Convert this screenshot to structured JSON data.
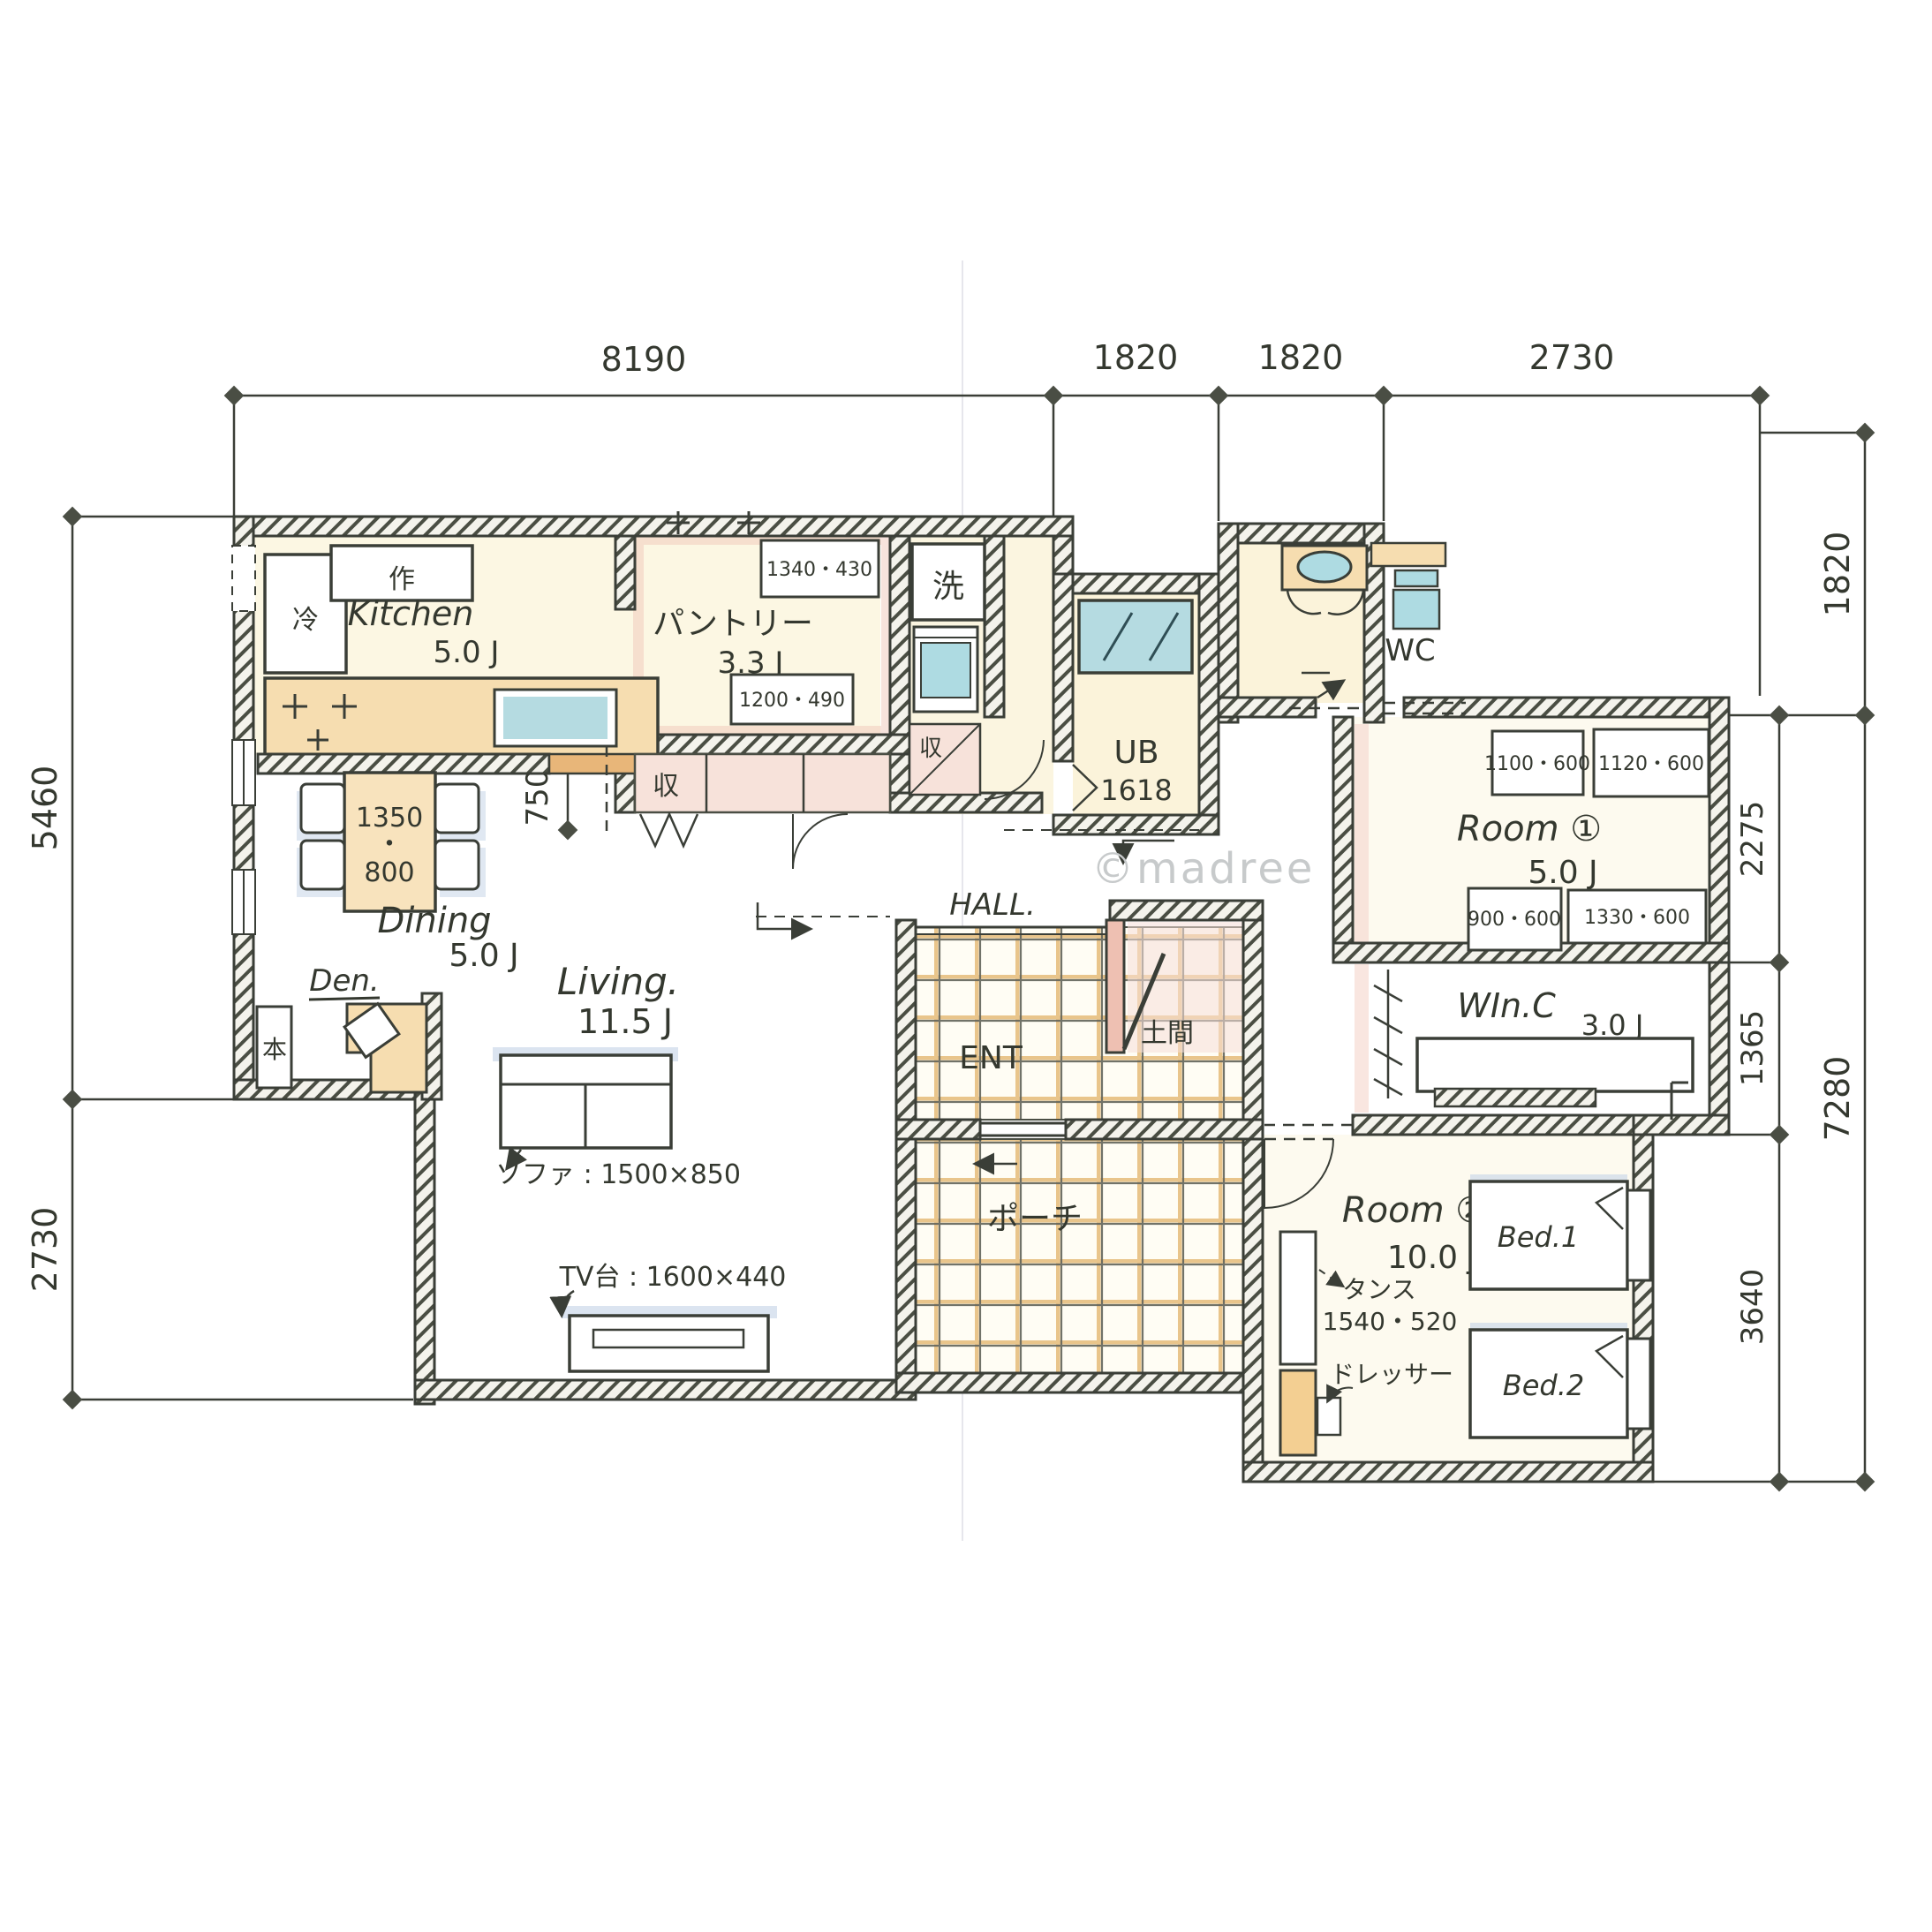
{
  "watermark": "©madree",
  "dimensions": {
    "top": [
      "8190",
      "1820",
      "1820",
      "2730"
    ],
    "left": [
      "5460",
      "2730"
    ],
    "right_outer": [
      "1820",
      "7280"
    ],
    "right_inner": [
      "2275",
      "1365",
      "3640"
    ],
    "kitchen_opening": [
      "1980",
      "750"
    ]
  },
  "rooms": {
    "kitchen": {
      "label": "Kitchen",
      "size": "5.0 J"
    },
    "pantry": {
      "label": "パントリー",
      "size": "3.3 J"
    },
    "dining": {
      "label": "Dining",
      "size": "5.0 J"
    },
    "living": {
      "label": "Living.",
      "size": "11.5 J"
    },
    "den": {
      "label": "Den."
    },
    "hall": {
      "label": "HALL."
    },
    "entrance": {
      "label": "ENT"
    },
    "doma": {
      "label": "土間"
    },
    "porch": {
      "label": "ポーチ"
    },
    "bath": {
      "label": "UB",
      "size": "1618"
    },
    "wc": {
      "label": "WC"
    },
    "room1": {
      "label": "Room ①",
      "size": "5.0 J"
    },
    "wic": {
      "label": "WIn.C",
      "size": "3.0 J"
    },
    "room2": {
      "label": "Room ②",
      "size": "10.0 J"
    }
  },
  "furniture": {
    "fridge": "冷",
    "work_counter": "作",
    "washer": "洗",
    "storage_pantry": "収",
    "storage_wash": "収",
    "bookshelf": "本",
    "dining_table": {
      "w": "1350",
      "sep": "・",
      "d": "800"
    },
    "sofa": "ソファ : 1500×850",
    "tv": "TV台 : 1600×440",
    "bed1": "Bed.1",
    "bed2": "Bed.2",
    "tansu_label": "タンス",
    "tansu_size": "1540・520",
    "dresser": "ドレッサー"
  },
  "closets": {
    "pantry_box1": "1340・430",
    "pantry_box2": "1200・490",
    "room1_box1": "1100・600",
    "room1_box2": "1120・600",
    "room1_box3": "900・600",
    "room1_box4": "1330・600"
  }
}
